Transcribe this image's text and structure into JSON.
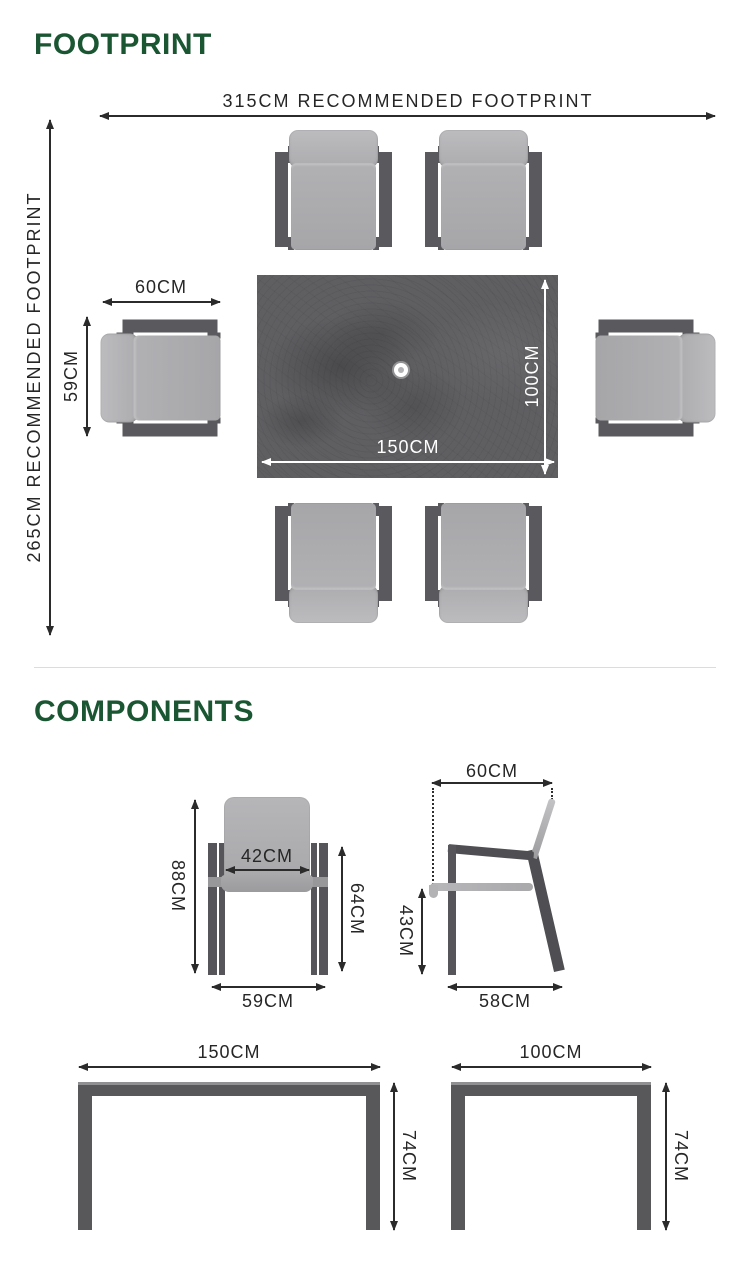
{
  "footprint": {
    "title": "FOOTPRINT",
    "width_label": "315CM RECOMMENDED FOOTPRINT",
    "height_label": "265CM RECOMMENDED FOOTPRINT",
    "chair_width": "60CM",
    "chair_depth": "59CM",
    "table_length": "150CM",
    "table_depth": "100CM"
  },
  "components": {
    "title": "COMPONENTS",
    "chair_front": {
      "height": "88CM",
      "seat_width": "42CM",
      "arm_height": "64CM",
      "width": "59CM"
    },
    "chair_side": {
      "depth": "60CM",
      "seat_height": "43CM",
      "base_depth": "58CM"
    },
    "table_front": {
      "length": "150CM",
      "height": "74CM"
    },
    "table_side": {
      "depth": "100CM",
      "height": "74CM"
    }
  },
  "colors": {
    "heading_green": "#1b5633",
    "dimension_text": "#262626",
    "white_dimension_text": "#ffffff",
    "table_marble_gray": "#5f5f62",
    "cushion_gray": "#acacaf",
    "frame_dark_gray": "#5a5a5e",
    "divider_gray": "#dcdcdc",
    "background": "#ffffff"
  }
}
